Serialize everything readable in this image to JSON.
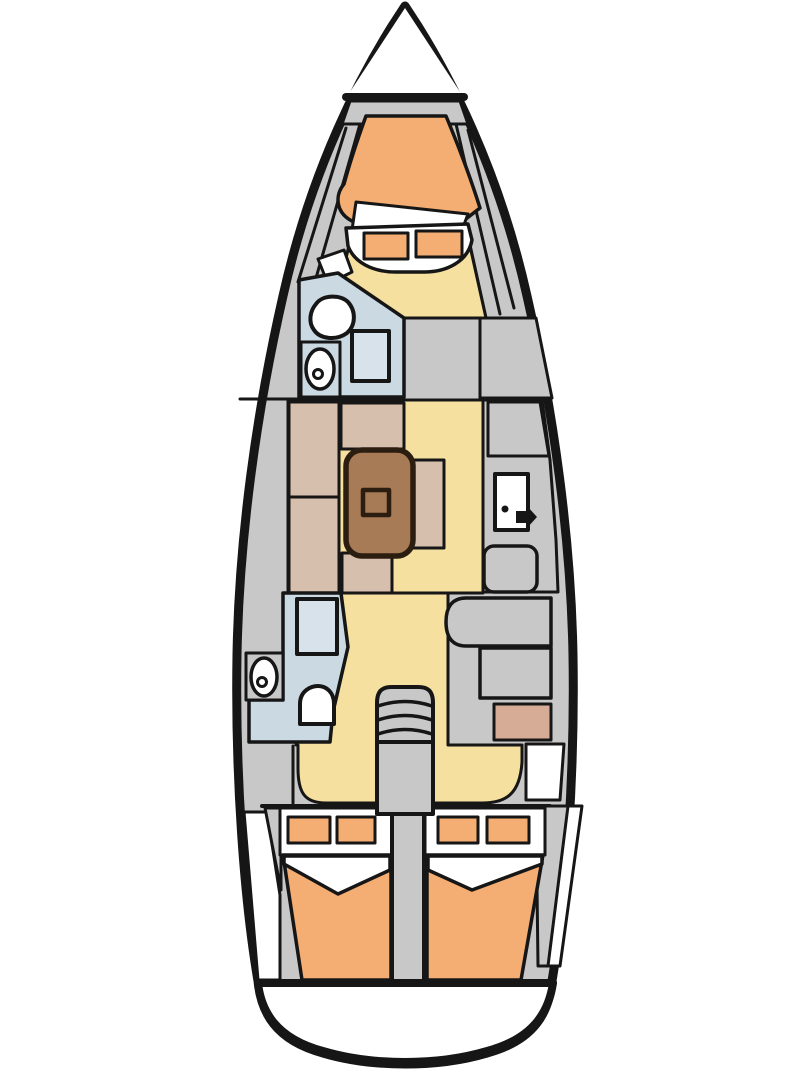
{
  "canvas": {
    "width": 810,
    "height": 1080,
    "background": "#ffffff"
  },
  "meta": {
    "subject": "sailboat-interior-floorplan-top-view"
  },
  "palette": {
    "ink": "#161616",
    "gray": "#c8c8c8",
    "white": "#ffffff",
    "sole_yellow": "#f5e0a0",
    "mattress_orange": "#f4ad72",
    "settee_tan": "#d7bfae",
    "table_brown": "#a67b55",
    "table_ink": "#2b1d10",
    "head_blue": "#cbd9e2",
    "shower_blue": "#d7e2ea",
    "galley_pink": "#d7ac97"
  },
  "diagram": {
    "shapes": [
      {
        "name": "hull-outline",
        "kind": "path",
        "d": "M 405 6 L 418 26 C 448 74 498 166 527 296 C 554 414 571 540 573 655 C 575 775 566 898 552 981 C 549 1012 535 1040 487 1053 C 460 1061 432 1064 405 1064 C 378 1064 350 1061 323 1053 C 275 1040 261 1012 258 981 C 244 898 235 775 237 655 C 239 540 256 414 283 296 C 312 166 362 74 392 26 Z",
        "fill": "#c8c8c8",
        "stroke": "#161616",
        "sw": 9
      },
      {
        "name": "bow-deck-white",
        "kind": "polygon",
        "points": "405,8 344,101 466,101",
        "fill": "#ffffff"
      },
      {
        "name": "transom-platform",
        "kind": "path",
        "d": "M 258 983 L 553 983 C 549 1010 535 1038 487 1051 C 460 1059 432 1062 405 1062 C 378 1062 350 1059 323 1051 C 275 1038 261 1010 258 983 Z",
        "fill": "#ffffff",
        "stroke": "#161616",
        "sw": 8
      },
      {
        "name": "bow-deck-line",
        "kind": "line",
        "x1": 346,
        "y1": 97,
        "x2": 464,
        "y2": 97,
        "stroke": "#161616",
        "sw": 8
      },
      {
        "name": "anchor-locker",
        "kind": "polygon",
        "points": "350,101 460,101 468,124 342,124",
        "fill": "#c8c8c8",
        "stroke": "#161616",
        "sw": 3
      },
      {
        "name": "bow-liner-line-port-1",
        "kind": "line",
        "x1": 346,
        "y1": 128,
        "x2": 298,
        "y2": 282,
        "stroke": "#161616",
        "sw": 3
      },
      {
        "name": "bow-liner-line-port-2",
        "kind": "line",
        "x1": 360,
        "y1": 124,
        "x2": 312,
        "y2": 292,
        "stroke": "#161616",
        "sw": 3
      },
      {
        "name": "bow-liner-line-stbd-1",
        "kind": "line",
        "x1": 444,
        "y1": 126,
        "x2": 486,
        "y2": 318,
        "stroke": "#161616",
        "sw": 3
      },
      {
        "name": "bow-liner-line-stbd-2",
        "kind": "line",
        "x1": 456,
        "y1": 124,
        "x2": 500,
        "y2": 314,
        "stroke": "#161616",
        "sw": 3
      },
      {
        "name": "bow-liner-line-stbd-3",
        "kind": "line",
        "x1": 468,
        "y1": 130,
        "x2": 514,
        "y2": 308,
        "stroke": "#161616",
        "sw": 3
      },
      {
        "name": "sole-forward-corridor",
        "kind": "polygon",
        "points": "352,232 466,228 486,318 404,318 341,278 347,254",
        "fill": "#f5e0a0",
        "stroke": "#161616",
        "sw": 3
      },
      {
        "name": "sole-salon",
        "kind": "polygon",
        "points": "288,400 483,400 483,593 288,593",
        "fill": "#f5e0a0",
        "stroke": "#161616",
        "sw": 3
      },
      {
        "name": "sole-aft",
        "kind": "path",
        "d": "M 296 593 L 448 593 L 448 745 L 522 745 L 522 762 C 520 794 506 803 482 803 L 326 803 C 304 803 298 792 298 768 L 298 745 L 296 745 Z",
        "fill": "#f5e0a0",
        "stroke": "#161616",
        "sw": 3
      },
      {
        "name": "vberth-mattress",
        "kind": "path",
        "d": "M 366 116 L 446 116 C 456 140 470 176 480 208 L 462 222 L 354 222 C 336 214 334 196 344 184 C 350 162 358 138 366 116 Z",
        "fill": "#f4ad72",
        "stroke": "#161616",
        "sw": 3.5
      },
      {
        "name": "vberth-sheet-fold",
        "kind": "polygon",
        "points": "356,202 468,214 462,230 352,230",
        "fill": "#ffffff",
        "stroke": "#161616",
        "sw": 3
      },
      {
        "name": "vberth-foot-seat",
        "kind": "path",
        "d": "M 346 228 L 468 224 L 472 240 C 468 262 446 272 424 272 L 396 272 C 372 272 354 262 348 246 Z",
        "fill": "#ffffff",
        "stroke": "#161616",
        "sw": 3.5
      },
      {
        "name": "vberth-cushion-left",
        "kind": "rect",
        "x": 364,
        "y": 233,
        "w": 44,
        "h": 26,
        "fill": "#f4ad72",
        "stroke": "#161616",
        "sw": 3
      },
      {
        "name": "vberth-cushion-right",
        "kind": "rect",
        "x": 416,
        "y": 231,
        "w": 46,
        "h": 26,
        "fill": "#f4ad72",
        "stroke": "#161616",
        "sw": 3
      },
      {
        "name": "vberth-entry-step",
        "kind": "polygon",
        "points": "318,259 344,250 352,272 328,284",
        "fill": "#ffffff",
        "stroke": "#161616",
        "sw": 3
      },
      {
        "name": "forward-head-room",
        "kind": "polygon",
        "points": "299,280 338,273 404,318 404,397 299,397",
        "fill": "#cbd9e2",
        "stroke": "#161616",
        "sw": 3.5
      },
      {
        "name": "forward-head-toilet",
        "kind": "path",
        "d": "M 316 304 C 322 295 340 294 348 302 C 356 311 356 325 347 333 C 336 341 320 339 314 330 C 308 322 310 311 316 304 Z",
        "fill": "#ffffff",
        "stroke": "#161616",
        "sw": 4
      },
      {
        "name": "forward-head-sink-counter",
        "kind": "rect",
        "x": 301,
        "y": 342,
        "w": 39,
        "h": 55,
        "fill": "#cbd9e2",
        "stroke": "#161616",
        "sw": 3
      },
      {
        "name": "forward-head-sink",
        "kind": "ellipse",
        "cx": 320,
        "cy": 369,
        "rx": 14,
        "ry": 20,
        "fill": "#ffffff",
        "stroke": "#161616",
        "sw": 3.5
      },
      {
        "name": "forward-head-sink-drain",
        "kind": "circle",
        "cx": 318,
        "cy": 374,
        "r": 4.5,
        "fill": "#ffffff",
        "stroke": "#161616",
        "sw": 3
      },
      {
        "name": "forward-head-shower",
        "kind": "rect",
        "x": 352,
        "y": 331,
        "w": 37,
        "h": 50,
        "fill": "#d7e2ea",
        "stroke": "#161616",
        "sw": 4
      },
      {
        "name": "bulkhead-line-port",
        "kind": "line",
        "x1": 240,
        "y1": 399,
        "x2": 299,
        "y2": 399,
        "stroke": "#161616",
        "sw": 3
      },
      {
        "name": "stbd-locker-forward",
        "kind": "polygon",
        "points": "480,318 536,318 552,398 480,398",
        "fill": "#c8c8c8",
        "stroke": "#161616",
        "sw": 3
      },
      {
        "name": "nav-station-area",
        "kind": "polygon",
        "points": "483,400 542,400 550,460 556,540 558,592 483,592",
        "fill": "#c8c8c8",
        "stroke": "#161616",
        "sw": 3
      },
      {
        "name": "stbd-locker-mid",
        "kind": "polygon",
        "points": "488,402 540,402 549,456 488,456",
        "fill": "#c8c8c8",
        "stroke": "#161616",
        "sw": 3
      },
      {
        "name": "nav-door-panel",
        "kind": "rect",
        "x": 495,
        "y": 474,
        "w": 33,
        "h": 56,
        "fill": "#ffffff",
        "stroke": "#161616",
        "sw": 4
      },
      {
        "name": "nav-door-dot",
        "kind": "circle",
        "cx": 505,
        "cy": 509,
        "r": 3.5,
        "fill": "#161616"
      },
      {
        "name": "nav-door-handle",
        "kind": "path",
        "d": "M 516 511 L 527 511 L 527 506 L 537 517 L 527 528 L 527 523 L 516 523 Z",
        "fill": "#161616"
      },
      {
        "name": "nav-seat",
        "kind": "rect",
        "x": 484,
        "y": 546,
        "w": 53,
        "h": 46,
        "rx": 10,
        "fill": "#c8c8c8",
        "stroke": "#161616",
        "sw": 3.5
      },
      {
        "name": "settee-back-upper",
        "kind": "rect",
        "x": 289,
        "y": 402,
        "w": 50,
        "h": 95,
        "fill": "#d7bfae",
        "stroke": "#161616",
        "sw": 3
      },
      {
        "name": "settee-back-lower",
        "kind": "rect",
        "x": 289,
        "y": 497,
        "w": 50,
        "h": 96,
        "fill": "#d7bfae",
        "stroke": "#161616",
        "sw": 3
      },
      {
        "name": "settee-top-bench",
        "kind": "rect",
        "x": 341,
        "y": 403,
        "w": 63,
        "h": 46,
        "fill": "#d7bfae",
        "stroke": "#161616",
        "sw": 3
      },
      {
        "name": "settee-bottom-bench",
        "kind": "rect",
        "x": 342,
        "y": 553,
        "w": 50,
        "h": 40,
        "fill": "#d7bfae",
        "stroke": "#161616",
        "sw": 3
      },
      {
        "name": "settee-right-bench",
        "kind": "rect",
        "x": 408,
        "y": 460,
        "w": 36,
        "h": 88,
        "fill": "#d7bfae",
        "stroke": "#161616",
        "sw": 3
      },
      {
        "name": "salon-table",
        "kind": "rect",
        "x": 346,
        "y": 450,
        "w": 67,
        "h": 106,
        "rx": 16,
        "fill": "#a67b55",
        "stroke": "#2b1d10",
        "sw": 5.5
      },
      {
        "name": "salon-table-center",
        "kind": "rect",
        "x": 363,
        "y": 490,
        "w": 26,
        "h": 25,
        "fill": "#a67b55",
        "stroke": "#2b1d10",
        "sw": 4.5
      },
      {
        "name": "aft-head-room",
        "kind": "polygon",
        "points": "283,593 341,593 348,647 333,712 330,742 249,742 249,700 283,700",
        "fill": "#cbd9e2",
        "stroke": "#161616",
        "sw": 3.5
      },
      {
        "name": "aft-head-shower",
        "kind": "rect",
        "x": 297,
        "y": 599,
        "w": 40,
        "h": 55,
        "fill": "#d7e2ea",
        "stroke": "#161616",
        "sw": 4
      },
      {
        "name": "aft-head-sink-counter",
        "kind": "rect",
        "x": 246,
        "y": 653,
        "w": 37,
        "h": 47,
        "fill": "#c8c8c8",
        "stroke": "#161616",
        "sw": 3
      },
      {
        "name": "aft-head-sink",
        "kind": "ellipse",
        "cx": 264,
        "cy": 677,
        "rx": 13,
        "ry": 19,
        "fill": "#ffffff",
        "stroke": "#161616",
        "sw": 3.5
      },
      {
        "name": "aft-head-sink-drain",
        "kind": "circle",
        "cx": 262,
        "cy": 682,
        "r": 4.5,
        "fill": "#ffffff",
        "stroke": "#161616",
        "sw": 3
      },
      {
        "name": "aft-head-toilet",
        "kind": "path",
        "d": "M 300 724 L 300 704 C 300 690 312 686 318 686 C 326 686 334 692 334 704 L 334 724 Z",
        "fill": "#ffffff",
        "stroke": "#161616",
        "sw": 4
      },
      {
        "name": "galley-counter-upper",
        "kind": "path",
        "d": "M 466 598 L 551 598 L 551 646 L 466 646 C 450 646 446 634 446 622 C 446 610 450 598 466 598 Z",
        "fill": "#c8c8c8",
        "stroke": "#161616",
        "sw": 3.5
      },
      {
        "name": "galley-counter-lower",
        "kind": "rect",
        "x": 480,
        "y": 648,
        "w": 71,
        "h": 50,
        "fill": "#c8c8c8",
        "stroke": "#161616",
        "sw": 3.5
      },
      {
        "name": "galley-stove",
        "kind": "rect",
        "x": 494,
        "y": 704,
        "w": 57,
        "h": 36,
        "fill": "#d7ac97",
        "stroke": "#161616",
        "sw": 3
      },
      {
        "name": "stbd-aft-deck-white",
        "kind": "polygon",
        "points": "526,744 564,744 560,800 526,800",
        "fill": "#ffffff",
        "stroke": "#161616",
        "sw": 3
      },
      {
        "name": "port-aft-locker-divider",
        "kind": "line",
        "x1": 293,
        "y1": 746,
        "x2": 293,
        "y2": 803,
        "stroke": "#161616",
        "sw": 3
      },
      {
        "name": "aft-cabin-bulkhead-line",
        "kind": "line",
        "x1": 262,
        "y1": 806,
        "x2": 550,
        "y2": 806,
        "stroke": "#161616",
        "sw": 4
      },
      {
        "name": "port-aft-white-wedge",
        "kind": "polygon",
        "points": "244,812 267,812 280,895 280,980 258,980",
        "fill": "#ffffff",
        "stroke": "#161616",
        "sw": 3
      },
      {
        "name": "port-aft-gray-wedge",
        "kind": "polygon",
        "points": "265,808 281,808 281,890",
        "fill": "#c8c8c8",
        "stroke": "#161616",
        "sw": 3
      },
      {
        "name": "stbd-aft-white-wedge",
        "kind": "polygon",
        "points": "565,806 582,806 560,966 546,966",
        "fill": "#ffffff",
        "stroke": "#161616",
        "sw": 3
      },
      {
        "name": "stbd-aft-gray-wedge",
        "kind": "polygon",
        "points": "536,806 568,806 548,966 538,966",
        "fill": "#c8c8c8",
        "stroke": "#161616",
        "sw": 3
      },
      {
        "name": "port-aft-berth-head",
        "kind": "rect",
        "x": 280,
        "y": 808,
        "w": 113,
        "h": 47,
        "fill": "#ffffff",
        "stroke": "#161616",
        "sw": 3
      },
      {
        "name": "port-aft-pillow-left",
        "kind": "rect",
        "x": 288,
        "y": 817,
        "w": 42,
        "h": 26,
        "fill": "#f4ad72",
        "stroke": "#161616",
        "sw": 3
      },
      {
        "name": "port-aft-pillow-right",
        "kind": "rect",
        "x": 337,
        "y": 817,
        "w": 38,
        "h": 26,
        "fill": "#f4ad72",
        "stroke": "#161616",
        "sw": 3
      },
      {
        "name": "port-aft-mattress",
        "kind": "polygon",
        "points": "283,855 391,855 391,980 302,980",
        "fill": "#f4ad72",
        "stroke": "#161616",
        "sw": 3.5
      },
      {
        "name": "port-aft-sheet-fold",
        "kind": "polygon",
        "points": "284,856 390,856 390,870 338,894 284,864",
        "fill": "#ffffff",
        "stroke": "#161616",
        "sw": 3.5
      },
      {
        "name": "stbd-aft-berth-head",
        "kind": "rect",
        "x": 425,
        "y": 808,
        "w": 120,
        "h": 47,
        "fill": "#ffffff",
        "stroke": "#161616",
        "sw": 3
      },
      {
        "name": "stbd-aft-pillow-left",
        "kind": "rect",
        "x": 438,
        "y": 817,
        "w": 40,
        "h": 26,
        "fill": "#f4ad72",
        "stroke": "#161616",
        "sw": 3
      },
      {
        "name": "stbd-aft-pillow-right",
        "kind": "rect",
        "x": 487,
        "y": 817,
        "w": 42,
        "h": 26,
        "fill": "#f4ad72",
        "stroke": "#161616",
        "sw": 3
      },
      {
        "name": "stbd-aft-mattress",
        "kind": "polygon",
        "points": "427,855 543,855 521,980 427,980",
        "fill": "#f4ad72",
        "stroke": "#161616",
        "sw": 3.5
      },
      {
        "name": "stbd-aft-sheet-fold",
        "kind": "polygon",
        "points": "428,856 542,856 542,864 472,890 428,870",
        "fill": "#ffffff",
        "stroke": "#161616",
        "sw": 3.5
      },
      {
        "name": "companionway-steps",
        "kind": "path",
        "d": "M 377 742 L 377 703 C 377 690 383 687 392 687 L 418 687 C 427 687 433 690 433 703 L 433 742 Z",
        "fill": "#c8c8c8",
        "stroke": "#161616",
        "sw": 4
      },
      {
        "name": "companionway-step-line-1",
        "kind": "path",
        "d": "M 378 706 C 396 700 414 700 432 706",
        "fill": "none",
        "stroke": "#161616",
        "sw": 3.5
      },
      {
        "name": "companionway-step-line-2",
        "kind": "path",
        "d": "M 378 720 C 396 714 414 714 432 720",
        "fill": "none",
        "stroke": "#161616",
        "sw": 3.5
      },
      {
        "name": "companionway-step-line-3",
        "kind": "path",
        "d": "M 378 734 C 396 728 414 728 432 734",
        "fill": "none",
        "stroke": "#161616",
        "sw": 3.5
      },
      {
        "name": "companionway-base",
        "kind": "rect",
        "x": 377,
        "y": 742,
        "w": 56,
        "h": 72,
        "fill": "#c8c8c8",
        "stroke": "#161616",
        "sw": 4
      },
      {
        "name": "engine-compartment-column",
        "kind": "rect",
        "x": 392,
        "y": 814,
        "w": 32,
        "h": 169,
        "fill": "#c8c8c8",
        "stroke": "#161616",
        "sw": 4
      },
      {
        "name": "transom-chord-line",
        "kind": "line",
        "x1": 258,
        "y1": 983,
        "x2": 553,
        "y2": 983,
        "stroke": "#161616",
        "sw": 8
      }
    ]
  }
}
